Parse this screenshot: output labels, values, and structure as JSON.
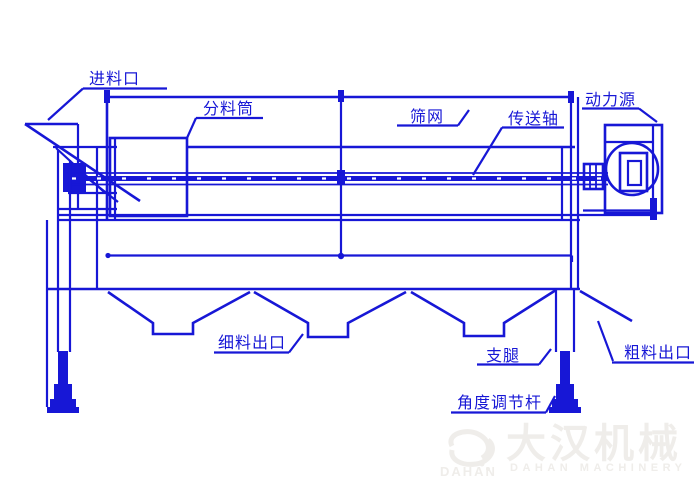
{
  "labels": {
    "feed_inlet": "进料口",
    "distributor_cylinder": "分料筒",
    "screen_mesh": "筛网",
    "transmission_shaft": "传送轴",
    "power_source": "动力源",
    "fine_material_outlet": "细料出口",
    "support_leg": "支腿",
    "coarse_material_outlet": "粗料出口",
    "angle_adjusting_rod": "角度调节杆"
  },
  "watermark": {
    "logo_text": "DAHAN",
    "name_cn": "大汉机械",
    "name_en": "DAHAN MACHINERY"
  },
  "colors": {
    "line_blue": "#1717d6",
    "watermark_gray": "#efedea",
    "background": "#ffffff"
  }
}
